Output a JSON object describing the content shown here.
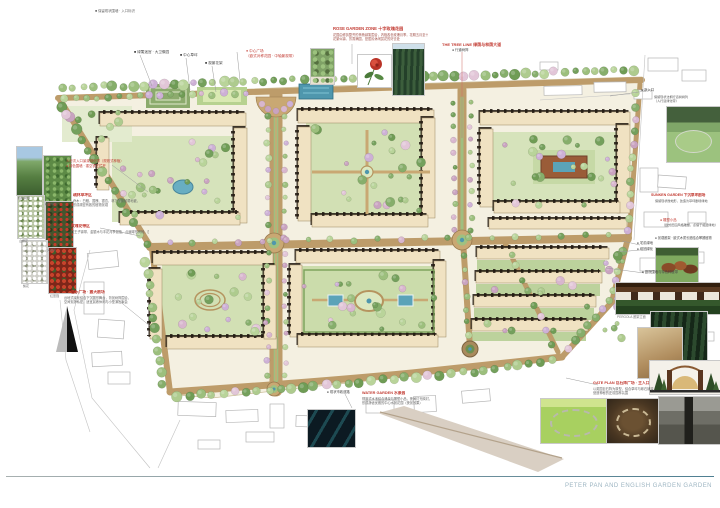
{
  "footer": {
    "title": "PETER PAN AND ENGLISH GARDEN GARDEN"
  },
  "photo_captions": {
    "l1": "桧柏树阵",
    "l2": "模纹绿篱",
    "l3": "山楂花",
    "l4": "火棘果",
    "l5": "梨花",
    "l6": "红蔷薇"
  },
  "annotations": {
    "top_left_note": "■ 保留现状围墙 · 入口标识",
    "top_labels": [
      {
        "text": "■ 绿篱迷宫 · 大卫像园"
      },
      {
        "text": "■ 中心草坪"
      },
      {
        "text": "■ 观景花架"
      }
    ],
    "center_plaza": {
      "line1": "● 中心广场",
      "line2": "（欧式对称花园 · 中轴景观带）"
    },
    "rose_garden": {
      "title": "ROSE GARDEN ZONE 十字玫瑰花园",
      "line1": "花园由修剪整齐的黄杨绿篱围合，内植各色玫瑰月季，花期五月至十月，",
      "line2": "花繁似锦、芳香满园，是居民休闲赏花的好去处"
    },
    "tree_line": {
      "title": "THE TREE LINE 绿荫与林荫大道",
      "sub": "● 行道树阵"
    },
    "left_entry": {
      "line1": "人行次入口景观绿化带（规则式种植）",
      "line2": "● 特色围墙 · 镂空铁艺栏杆"
    },
    "left_grove": {
      "title": "疏林草坪区",
      "line1": "乔木：白蜡、国槐、银杏，林下配置耐荫地被，",
      "line2": "形成疏密有致的植物景观"
    },
    "left_rose_belt": {
      "title": "玫瑰花带区",
      "line1": "红王子锦带、金银木与丰花月季混植，点缀球形黄杨，四季有景"
    },
    "music_plaza": {
      "title": "音乐广场 · 露天剧场",
      "line1": "台地式绿化结合下沉圆形舞台，背景树阵围合，",
      "line2": "空间安静私密，适宜晨练休闲与小型演出聚会"
    },
    "water_garden": {
      "title": "WATER GARDEN 水景园",
      "line1": "规则式水池结合涌泉与雕塑小品，夜间灯光映衬，",
      "line2": "形成静谧优雅的中心水景花园（夜景效果）"
    },
    "right_entry": {
      "bullet": "● 次入口",
      "line1": "保留现状法桐行道树树列",
      "line2": "（人行道绿化带）"
    },
    "sunken_garden": {
      "title": "SUNKEN GARDEN 下沉草坪剧场",
      "sub": "保留现状微地形，改造为草坪剧场绿地"
    },
    "right_sculpture": {
      "bullet": "● 雕塑小品",
      "sub": "（欧式田园风格雕塑，点缀于组团绿地）"
    },
    "right_pergola": "● 景观廊架 · 欧式木质长廊结合攀援植物",
    "right_b1": "● 宅前绿地",
    "right_b2": "● 组团绿化",
    "right_b3": "● 庭院围墙与特色种植带",
    "gate_plan": {
      "title": "GATE PLAN 巨石阵广场 · 主入口",
      "line1": "以英国巨石阵为原型，结合草坪与砾石铺装，",
      "line2": "营造神秘的史前园林氛围"
    },
    "se_note": "● 现状市政道路",
    "pergola_caption": "PERGOLA 廊架立面"
  },
  "colors": {
    "road_tan": "#bd9c6a",
    "tree_green": "#86ae6b",
    "tree_pink": "#d8b6ce",
    "water_blue": "#4f97ad",
    "building_cream": "#f0e2c2",
    "annotation_red": "#c23b32"
  }
}
